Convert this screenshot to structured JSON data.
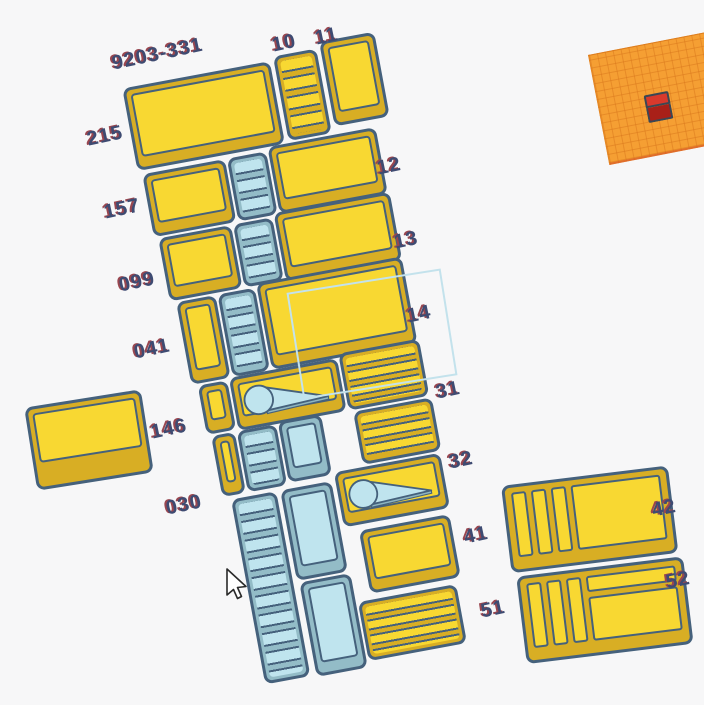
{
  "app": {
    "name": "3d-cad-viewport"
  },
  "colors": {
    "background": "#f7f7f8",
    "outline": "#45617c",
    "yellow_top": "#f8d832",
    "yellow_wall": "#d8ae24",
    "blue_top": "#bfe4ee",
    "blue_wall": "#93bcc7",
    "label_text": "#3e4b72",
    "label_shadow": "#99464f",
    "selection": "#c3e2ec",
    "plane": "#f59f33",
    "plane_grid": "#d8761b",
    "cube_top": "#d8392c",
    "cube_front": "#a92018"
  },
  "labels": [
    {
      "id": "9203-331",
      "text": "9203-331"
    },
    {
      "id": "10",
      "text": "10"
    },
    {
      "id": "11",
      "text": "11"
    },
    {
      "id": "215",
      "text": "215"
    },
    {
      "id": "12",
      "text": "12"
    },
    {
      "id": "157",
      "text": "157"
    },
    {
      "id": "13",
      "text": "13"
    },
    {
      "id": "099",
      "text": "099"
    },
    {
      "id": "14",
      "text": "14"
    },
    {
      "id": "041",
      "text": "041"
    },
    {
      "id": "31",
      "text": "31"
    },
    {
      "id": "146",
      "text": "146"
    },
    {
      "id": "32",
      "text": "32"
    },
    {
      "id": "030",
      "text": "030"
    },
    {
      "id": "41",
      "text": "41"
    },
    {
      "id": "51",
      "text": "51"
    },
    {
      "id": "42",
      "text": "42"
    },
    {
      "id": "52",
      "text": "52"
    }
  ]
}
